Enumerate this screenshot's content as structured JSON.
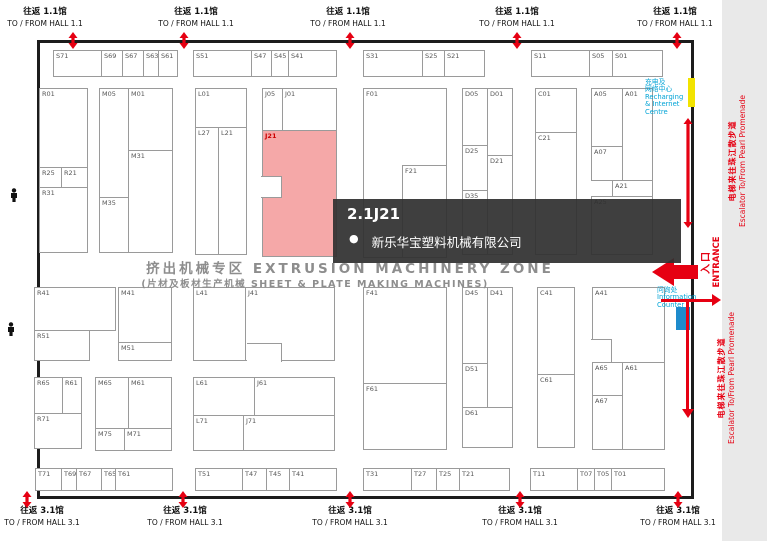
{
  "hall_links": {
    "top": {
      "zh": "往返 1.1馆",
      "en": "TO / FROM HALL 1.1",
      "centers": [
        45,
        196,
        348,
        517,
        675
      ],
      "arrows": [
        73,
        184,
        350,
        517,
        677
      ]
    },
    "bottom": {
      "zh": "往返 3.1馆",
      "en": "TO / FROM HALL 3.1",
      "centers": [
        42,
        185,
        350,
        520,
        678
      ],
      "arrows": [
        27,
        183,
        350,
        520,
        678
      ]
    }
  },
  "zone": {
    "line1": "挤出机械专区 EXTRUSION MACHINERY ZONE",
    "line2": "(片材及板材生产机械 SHEET & PLATE MAKING MACHINES)"
  },
  "tooltip": {
    "booth": "2.1J21",
    "company": "新乐华宝塑料机械有限公司"
  },
  "side": {
    "recharge": [
      "充电及",
      "网络中心",
      "Recharging",
      "& Internet",
      "Centre"
    ],
    "info": [
      "问询处",
      "Information",
      "Counter"
    ],
    "entrance_zh": "入口",
    "entrance_en": "ENTRANCE",
    "escalator_zh": "电梯来往珠江散步道",
    "escalator_en": "Escalator To/From Pearl Promenade"
  },
  "colors": {
    "highlight": "#f5a8a8",
    "arrow_red": "#e60012",
    "cyan": "#00a3d6",
    "info_blue": "#1e8bcc",
    "marker_yellow": "#f2e300"
  },
  "highlight_booth": "J21",
  "booths": [
    [
      "S71",
      53,
      50,
      49,
      27
    ],
    [
      "S69",
      101,
      50,
      22,
      27
    ],
    [
      "S67",
      122,
      50,
      22,
      27
    ],
    [
      "S63",
      143,
      50,
      16,
      27
    ],
    [
      "S61",
      158,
      50,
      20,
      27
    ],
    [
      "S51",
      193,
      50,
      59,
      27
    ],
    [
      "S47",
      251,
      50,
      21,
      27
    ],
    [
      "S45",
      271,
      50,
      18,
      27
    ],
    [
      "S41",
      288,
      50,
      49,
      27
    ],
    [
      "S31",
      363,
      50,
      60,
      27
    ],
    [
      "S25",
      422,
      50,
      23,
      27
    ],
    [
      "S21",
      444,
      50,
      41,
      27
    ],
    [
      "S11",
      531,
      50,
      59,
      27
    ],
    [
      "S05",
      589,
      50,
      24,
      27
    ],
    [
      "S01",
      612,
      50,
      51,
      27
    ],
    [
      "R01",
      39,
      88,
      49,
      80
    ],
    [
      "R25",
      39,
      167,
      23,
      21
    ],
    [
      "R21",
      61,
      167,
      27,
      21
    ],
    [
      "R31",
      39,
      187,
      49,
      66
    ],
    [
      "M05",
      99,
      88,
      30,
      110
    ],
    [
      "M35",
      99,
      197,
      30,
      56
    ],
    [
      "M01",
      128,
      88,
      45,
      63
    ],
    [
      "M31",
      128,
      150,
      45,
      103
    ],
    [
      "L01",
      195,
      88,
      52,
      40
    ],
    [
      "L27",
      195,
      127,
      24,
      128
    ],
    [
      "L21",
      218,
      127,
      29,
      128
    ],
    [
      "J05",
      262,
      88,
      21,
      43
    ],
    [
      "J01",
      282,
      88,
      55,
      43
    ],
    [
      "J21",
      262,
      130,
      75,
      127
    ],
    [
      "F01",
      363,
      88,
      84,
      170
    ],
    [
      "F21",
      402,
      165,
      45,
      93
    ],
    [
      "D05",
      462,
      88,
      26,
      58
    ],
    [
      "D25",
      462,
      145,
      26,
      46
    ],
    [
      "D35",
      462,
      190,
      26,
      65
    ],
    [
      "D01",
      487,
      88,
      26,
      68
    ],
    [
      "D21",
      487,
      155,
      26,
      100
    ],
    [
      "C01",
      535,
      88,
      42,
      45
    ],
    [
      "C21",
      535,
      132,
      42,
      123
    ],
    [
      "A05",
      591,
      88,
      32,
      59
    ],
    [
      "A07",
      591,
      146,
      32,
      35
    ],
    [
      "A01",
      622,
      88,
      31,
      93
    ],
    [
      "A21",
      612,
      180,
      41,
      17
    ],
    [
      "A25",
      591,
      196,
      62,
      59
    ],
    [
      "R41",
      34,
      287,
      82,
      44
    ],
    [
      "R51",
      34,
      330,
      56,
      31
    ],
    [
      "M41",
      118,
      287,
      54,
      56
    ],
    [
      "M51",
      118,
      342,
      54,
      19
    ],
    [
      "L41",
      193,
      287,
      53,
      74
    ],
    [
      "J41",
      245,
      287,
      90,
      74
    ],
    [
      "F41",
      363,
      287,
      84,
      97
    ],
    [
      "F61",
      363,
      383,
      84,
      67
    ],
    [
      "D45",
      462,
      287,
      26,
      77
    ],
    [
      "D51",
      462,
      363,
      26,
      45
    ],
    [
      "D41",
      487,
      287,
      26,
      121
    ],
    [
      "D61",
      462,
      407,
      51,
      41
    ],
    [
      "C41",
      537,
      287,
      38,
      88
    ],
    [
      "C61",
      537,
      374,
      38,
      74
    ],
    [
      "A41",
      592,
      287,
      73,
      76
    ],
    [
      "A65",
      592,
      362,
      31,
      34
    ],
    [
      "A67",
      592,
      395,
      31,
      55
    ],
    [
      "A61",
      622,
      362,
      43,
      88
    ],
    [
      "R65",
      34,
      377,
      29,
      37
    ],
    [
      "R61",
      62,
      377,
      20,
      37
    ],
    [
      "R71",
      34,
      413,
      48,
      36
    ],
    [
      "M65",
      95,
      377,
      34,
      52
    ],
    [
      "M61",
      128,
      377,
      44,
      52
    ],
    [
      "M75",
      95,
      428,
      30,
      23
    ],
    [
      "M71",
      124,
      428,
      48,
      23
    ],
    [
      "L61",
      193,
      377,
      62,
      39
    ],
    [
      "J61",
      254,
      377,
      81,
      39
    ],
    [
      "L71",
      193,
      415,
      51,
      36
    ],
    [
      "J71",
      243,
      415,
      92,
      36
    ],
    [
      "T71",
      35,
      468,
      27,
      23
    ],
    [
      "T69",
      61,
      468,
      16,
      23
    ],
    [
      "T67",
      76,
      468,
      26,
      23
    ],
    [
      "T65",
      101,
      468,
      15,
      23
    ],
    [
      "T61",
      115,
      468,
      58,
      23
    ],
    [
      "T51",
      195,
      468,
      48,
      23
    ],
    [
      "T47",
      242,
      468,
      25,
      23
    ],
    [
      "T45",
      266,
      468,
      24,
      23
    ],
    [
      "T41",
      289,
      468,
      48,
      23
    ],
    [
      "T31",
      363,
      468,
      49,
      23
    ],
    [
      "T27",
      411,
      468,
      26,
      23
    ],
    [
      "T25",
      436,
      468,
      24,
      23
    ],
    [
      "T21",
      459,
      468,
      51,
      23
    ],
    [
      "T11",
      530,
      468,
      48,
      23
    ],
    [
      "T07",
      577,
      468,
      18,
      23
    ],
    [
      "T05",
      594,
      468,
      18,
      23
    ],
    [
      "T01",
      611,
      468,
      54,
      23
    ]
  ],
  "cutouts": [
    {
      "x": 261,
      "y": 176,
      "w": 21,
      "h": 22,
      "sides": "trb"
    },
    {
      "x": 247,
      "y": 343,
      "w": 35,
      "h": 19,
      "sides": "tr"
    },
    {
      "x": 591,
      "y": 339,
      "w": 21,
      "h": 23,
      "sides": "tr"
    }
  ]
}
